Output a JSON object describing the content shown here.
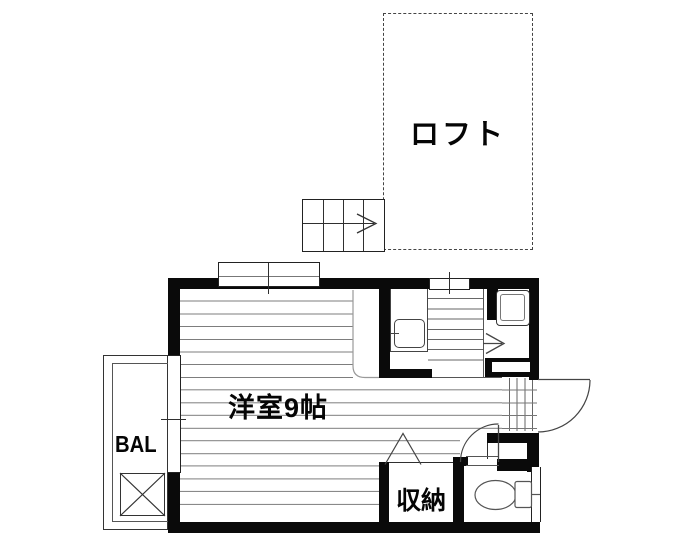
{
  "floorplan": {
    "type": "japanese-apartment-floorplan",
    "rooms": {
      "loft": {
        "label": "ロフト"
      },
      "main_room": {
        "label": "洋室9帖"
      },
      "storage": {
        "label": "収納"
      },
      "balcony": {
        "label": "BAL"
      }
    },
    "symbols": {
      "stairs_direction": "arrow-right",
      "loft_stairs_direction": "arrow-right",
      "entrance_door": "quarter-arc-swing-out",
      "toilet_door": "quarter-arc-swing-in",
      "closet_door": "triangle-fold",
      "balcony_box": "x-crossed-square"
    },
    "colors": {
      "wall": "#0a0a0a",
      "thin_line": "#444444",
      "floor_line": "#7d7d7d",
      "background": "#ffffff"
    }
  }
}
